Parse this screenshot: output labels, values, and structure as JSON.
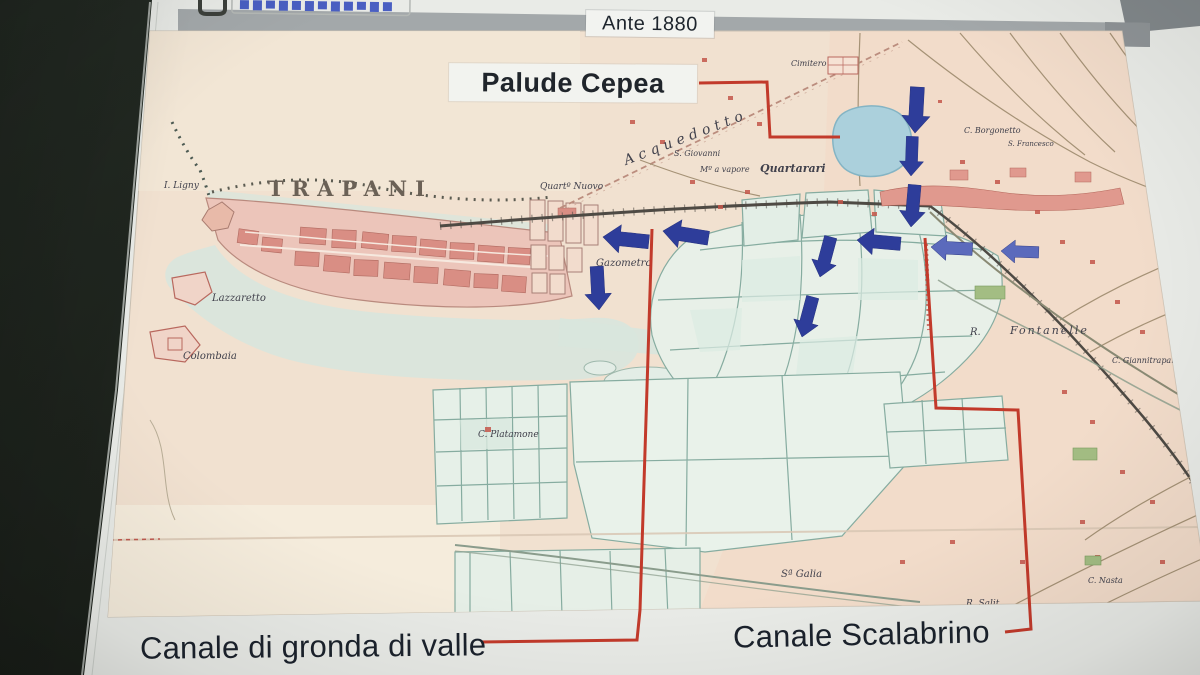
{
  "header": {
    "era_label": "Ante 1880"
  },
  "annotations": {
    "palude": "Palude Cepea",
    "canale_gronda": "Canale di gronda di valle",
    "canale_scalabrino": "Canale Scalabrino"
  },
  "map": {
    "city_title": "TRAPANI",
    "labels": [
      {
        "id": "ligny",
        "text": "I. Ligny"
      },
      {
        "id": "lazzaretto",
        "text": "Lazzaretto"
      },
      {
        "id": "colombaia",
        "text": "Colombaia"
      },
      {
        "id": "quartiere-nuovo",
        "text": "Quartº Nuovo"
      },
      {
        "id": "gazometro",
        "text": "Gazometro"
      },
      {
        "id": "s-giovanni",
        "text": "S. Giovanni"
      },
      {
        "id": "molino-a-vapore",
        "text": "Mº a vapore"
      },
      {
        "id": "quartarari",
        "text": "Quartarari"
      },
      {
        "id": "cimitero",
        "text": "Cimitero"
      },
      {
        "id": "acquedotto",
        "text": "Acquedotto"
      },
      {
        "id": "c-borgonetto",
        "text": "C. Borgonetto"
      },
      {
        "id": "s-francesco",
        "text": "S. Francesco"
      },
      {
        "id": "r",
        "text": "R."
      },
      {
        "id": "fontanelle",
        "text": "Fontanelle"
      },
      {
        "id": "c-giannitrapani",
        "text": "C. Giannitrapani"
      },
      {
        "id": "c-platamone",
        "text": "C. Platamone"
      },
      {
        "id": "s-galia",
        "text": "Sª Galia"
      },
      {
        "id": "c-nasta",
        "text": "C. Nasta"
      },
      {
        "id": "r-salito",
        "text": "R. Salit"
      }
    ]
  },
  "colors": {
    "annotation_red": "#c23a2b",
    "arrow_blue": "#2e3d9a",
    "arrow_blue_light": "#5b6abc",
    "lake_blue": "#abd0dc",
    "city_pink": "#d98e84",
    "saline_teal": "#86aca0",
    "map_beige": "#f1e1d0",
    "background_dark": "#1d221c"
  }
}
